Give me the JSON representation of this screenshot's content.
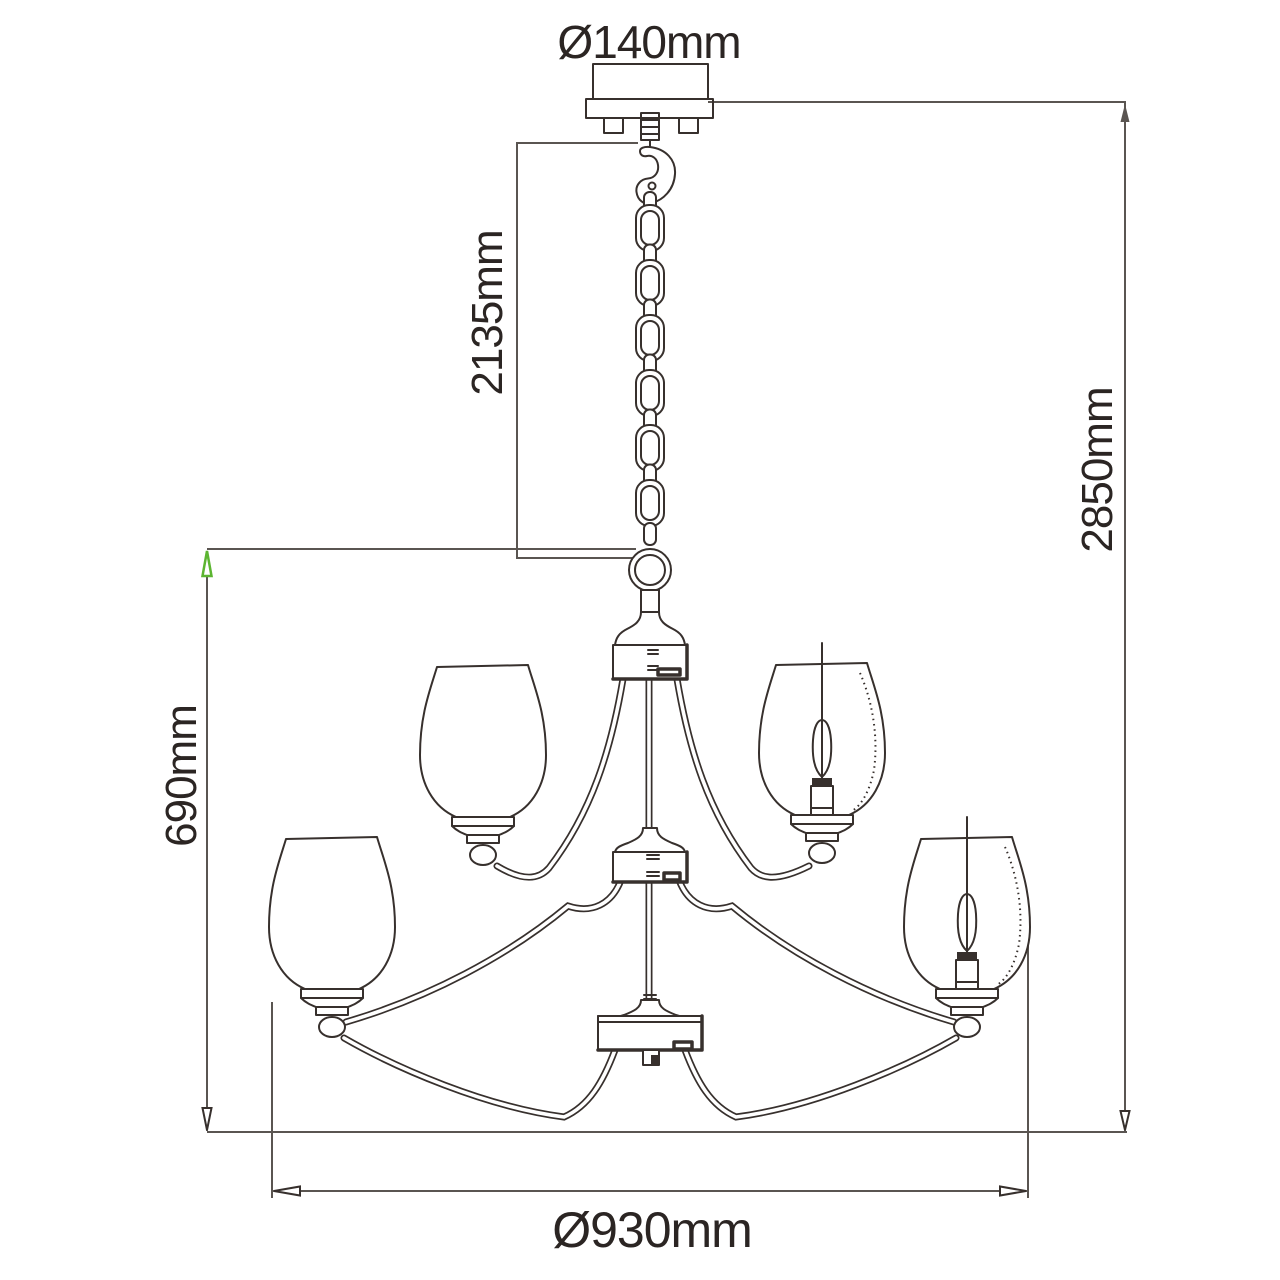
{
  "diagram": {
    "kind": "technical dimension drawing",
    "subject": "two-tier chandelier with chain suspension",
    "labels": {
      "canopy_diameter": "Ø140mm",
      "chain_length": "2135mm",
      "total_height": "2850mm",
      "body_height": "690mm",
      "body_diameter": "Ø930mm"
    },
    "colors": {
      "background": "#ffffff",
      "line": "#37302d",
      "dimension": "#5a5551",
      "green_arrow": "#5cb531",
      "text": "#2b2523"
    },
    "parts": [
      "ceiling canopy with mounting tabs",
      "suspension chain with carabiner hook",
      "hanger ring",
      "upper hub",
      "middle hub",
      "bottom hub with finial",
      "two upper tulip glass shades",
      "two lower tulip glass shades",
      "candle bulbs in right-hand shades"
    ]
  }
}
